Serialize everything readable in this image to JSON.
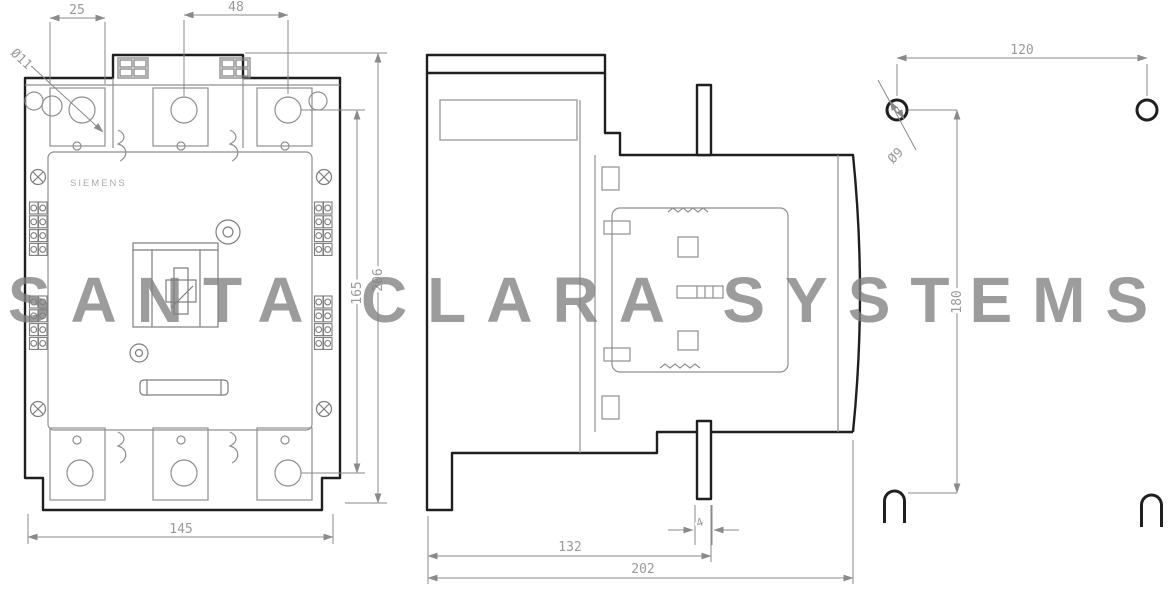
{
  "watermark": {
    "text": "SANTA CLARA SYSTEMS"
  },
  "front_view": {
    "brand": "SIEMENS",
    "dims": {
      "hole_offset": "25",
      "hole_pitch": "48",
      "terminal_hole_diameter": "Ø11",
      "width": "145",
      "inner_height": "165",
      "overall_height": "206"
    }
  },
  "side_view": {
    "dims": {
      "body_depth": "132",
      "overall_depth": "202",
      "tab_width": "4"
    }
  },
  "mounting_plan": {
    "dims": {
      "hole_spacing_horizontal": "120",
      "hole_spacing_vertical": "180",
      "hole_diameter": "Ø9"
    }
  },
  "colors": {
    "background": "#ffffff",
    "outline": "#1f1f1f",
    "detail_gray": "#8f8f8f",
    "dimension_gray": "#9a9a9a",
    "watermark_gray": "#808080"
  }
}
